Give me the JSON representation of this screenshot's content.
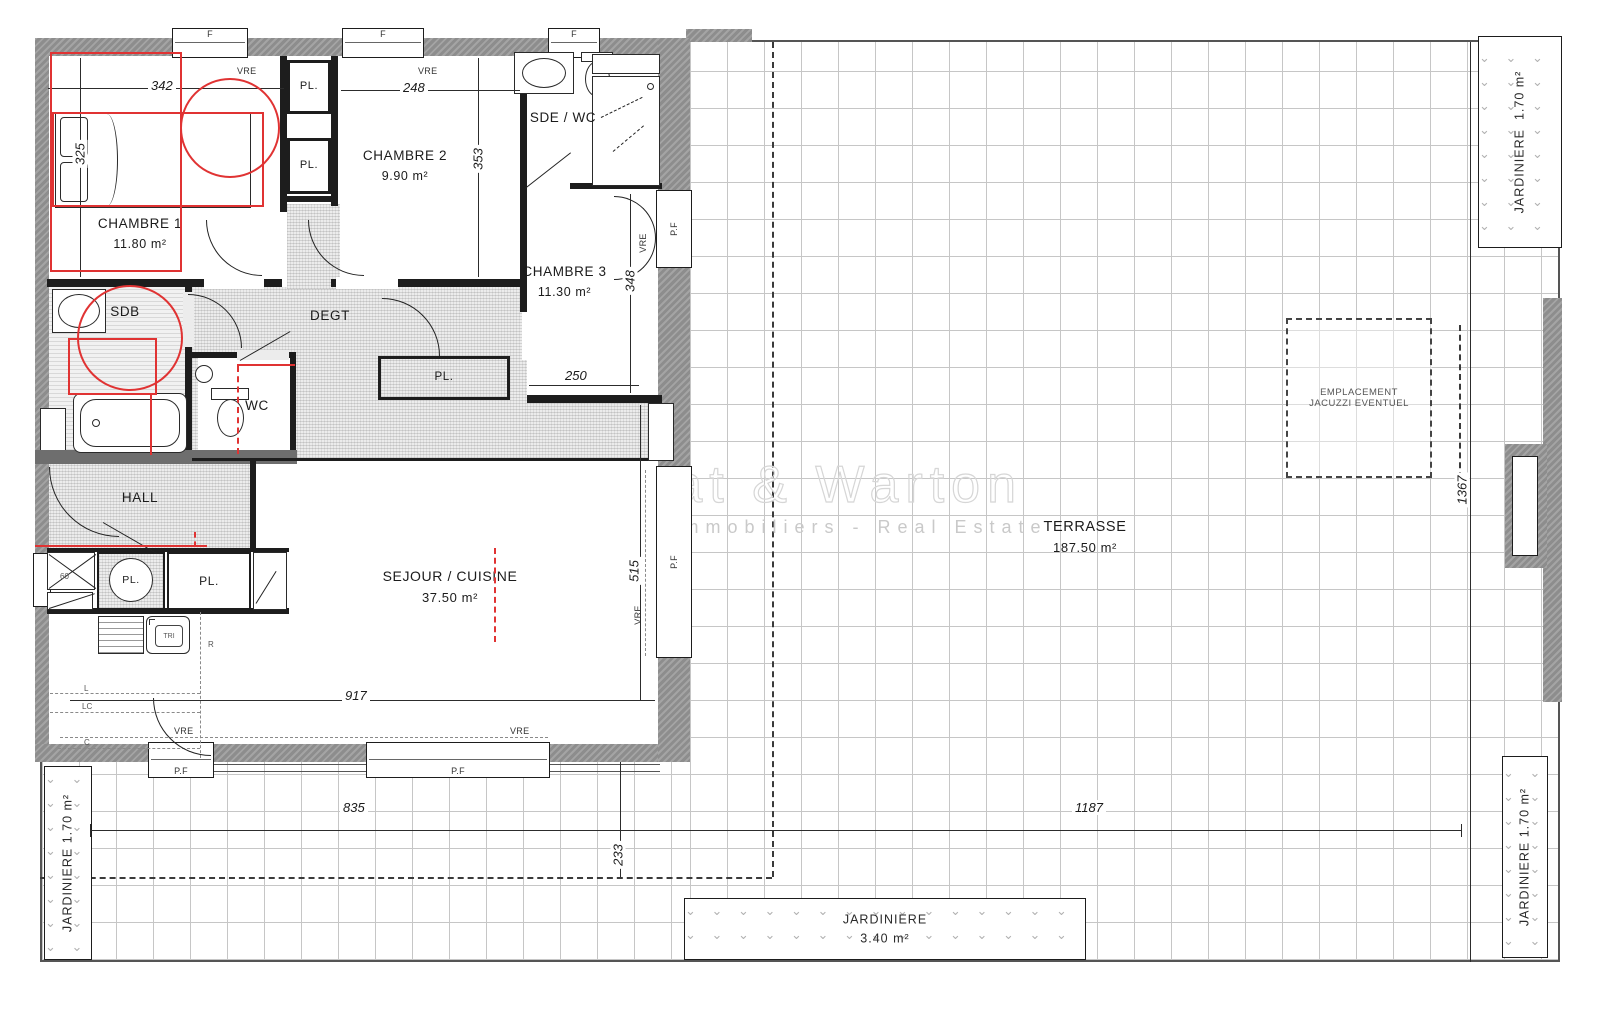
{
  "watermark": {
    "title": "Canat & Warton",
    "subtitle": "Cabinets Immobiliers - Real Estate"
  },
  "rooms": {
    "chambre1": {
      "name": "CHAMBRE 1",
      "area": "11.80 m²"
    },
    "chambre2": {
      "name": "CHAMBRE 2",
      "area": "9.90 m²"
    },
    "chambre3": {
      "name": "CHAMBRE 3",
      "area": "11.30 m²"
    },
    "sde_wc": {
      "name": "SDE / WC"
    },
    "sdb": {
      "name": "SDB"
    },
    "degt": {
      "name": "DEGT"
    },
    "wc": {
      "name": "WC"
    },
    "hall": {
      "name": "HALL"
    },
    "sejour": {
      "name": "SEJOUR / CUISINE",
      "area": "37.50 m²"
    },
    "terrasse": {
      "name": "TERRASSE",
      "area": "187.50 m²"
    },
    "jacuzzi": {
      "line1": "EMPLACEMENT",
      "line2": "JACUZZI EVENTUEL"
    },
    "jardiniere_top_right": {
      "name": "JARDINIERE",
      "area": "1.70 m²"
    },
    "jardiniere_bottom_left": {
      "name": "JARDINIERE",
      "area": "1.70 m²"
    },
    "jardiniere_bottom_right": {
      "name": "JARDINIERE",
      "area": "1.70 m²"
    },
    "jardiniere_bottom_center": {
      "name": "JARDINIERE",
      "area": "3.40 m²"
    }
  },
  "labels": {
    "pl": "PL.",
    "vre": "VRE",
    "f": "F",
    "pf": "P.F",
    "tri": "TRI",
    "r": "R",
    "l": "L",
    "lc": "LC",
    "c": "C",
    "w60": "60"
  },
  "dims": {
    "c1_w": "342",
    "c1_h": "325",
    "c2_w": "248",
    "c2_h": "353",
    "c3_h": "348",
    "c3_w": "250",
    "sej_w": "917",
    "sej_h": "515",
    "bottom_left": "835",
    "bottom_right": "1187",
    "bottom_offset": "233",
    "terrace_h": "1367"
  },
  "colors": {
    "wall": "#8d8d8d",
    "line": "#1d1d1d",
    "annotation": "#e03333",
    "grid": "#c6c6c6"
  },
  "icons": {
    "plant": "⌄"
  }
}
